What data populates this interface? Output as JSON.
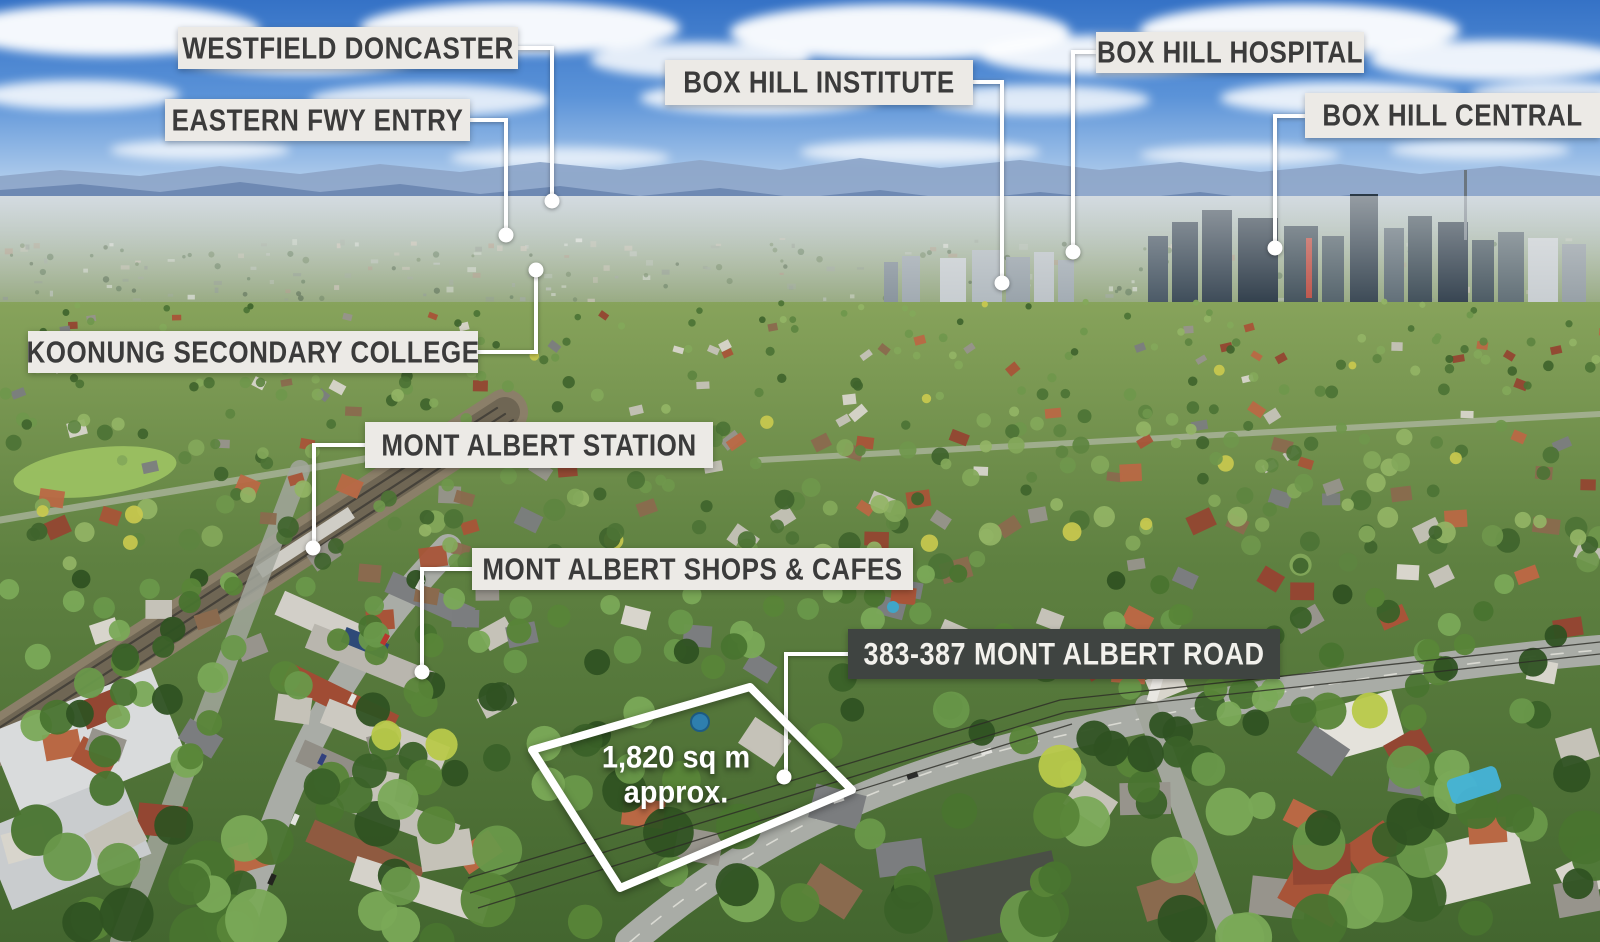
{
  "colors": {
    "label_bg": "#eceae6",
    "label_text": "#3b3b3b",
    "label_dark_bg": "#3f4441",
    "label_dark_text": "#f2f1ec",
    "annotation_white": "#ffffff"
  },
  "landmarks": [
    {
      "name": "WESTFIELD DONCASTER"
    },
    {
      "name": "EASTERN FWY ENTRY"
    },
    {
      "name": "BOX HILL INSTITUTE"
    },
    {
      "name": "BOX HILL HOSPITAL"
    },
    {
      "name": "BOX HILL CENTRAL"
    },
    {
      "name": "KOONUNG SECONDARY COLLEGE"
    },
    {
      "name": "MONT ALBERT STATION"
    },
    {
      "name": "MONT ALBERT SHOPS & CAFES"
    }
  ],
  "property": {
    "address": "383-387 MONT ALBERT ROAD",
    "area_line_1": "1,820 sq m",
    "area_line_2": "approx."
  }
}
